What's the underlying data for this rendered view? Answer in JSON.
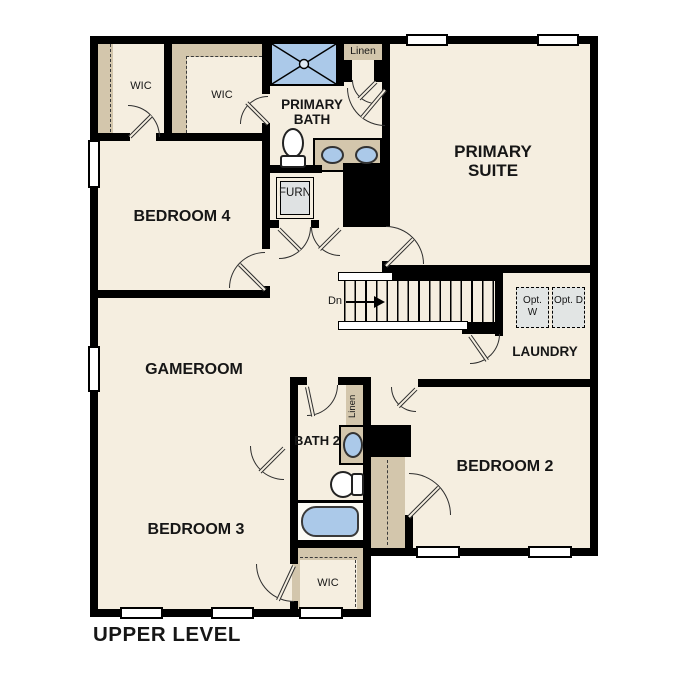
{
  "floor_plan": {
    "title": "UPPER LEVEL",
    "rooms": {
      "primary_suite": "PRIMARY SUITE",
      "primary_bath": "PRIMARY BATH",
      "bedroom_2": "BEDROOM 2",
      "bedroom_3": "BEDROOM 3",
      "bedroom_4": "BEDROOM 4",
      "gameroom": "GAMEROOM",
      "laundry": "LAUNDRY",
      "bath_2": "BATH 2",
      "wic_1": "WIC",
      "wic_2": "WIC",
      "wic_3": "WIC",
      "linen_1": "Linen",
      "linen_2": "Linen",
      "furnace": "FURN"
    },
    "annotations": {
      "stairs_direction": "Dn",
      "optional_washer": "Opt. W",
      "optional_dryer": "Opt. D"
    },
    "fixtures": [
      "shower-icon",
      "double-vanity-sinks-icon",
      "toilet-icon",
      "furnace-icon",
      "sink-icon",
      "bathtub-icon",
      "stairs-icon",
      "washer-optional-icon",
      "dryer-optional-icon"
    ],
    "colors": {
      "wall": "#000000",
      "floor": "#f5eee0",
      "closet_tan": "#d3c6ac",
      "fixture_blue": "#abc9e9",
      "appliance_gray": "#e2e5e4",
      "background": "#ffffff",
      "text": "#161616"
    }
  }
}
